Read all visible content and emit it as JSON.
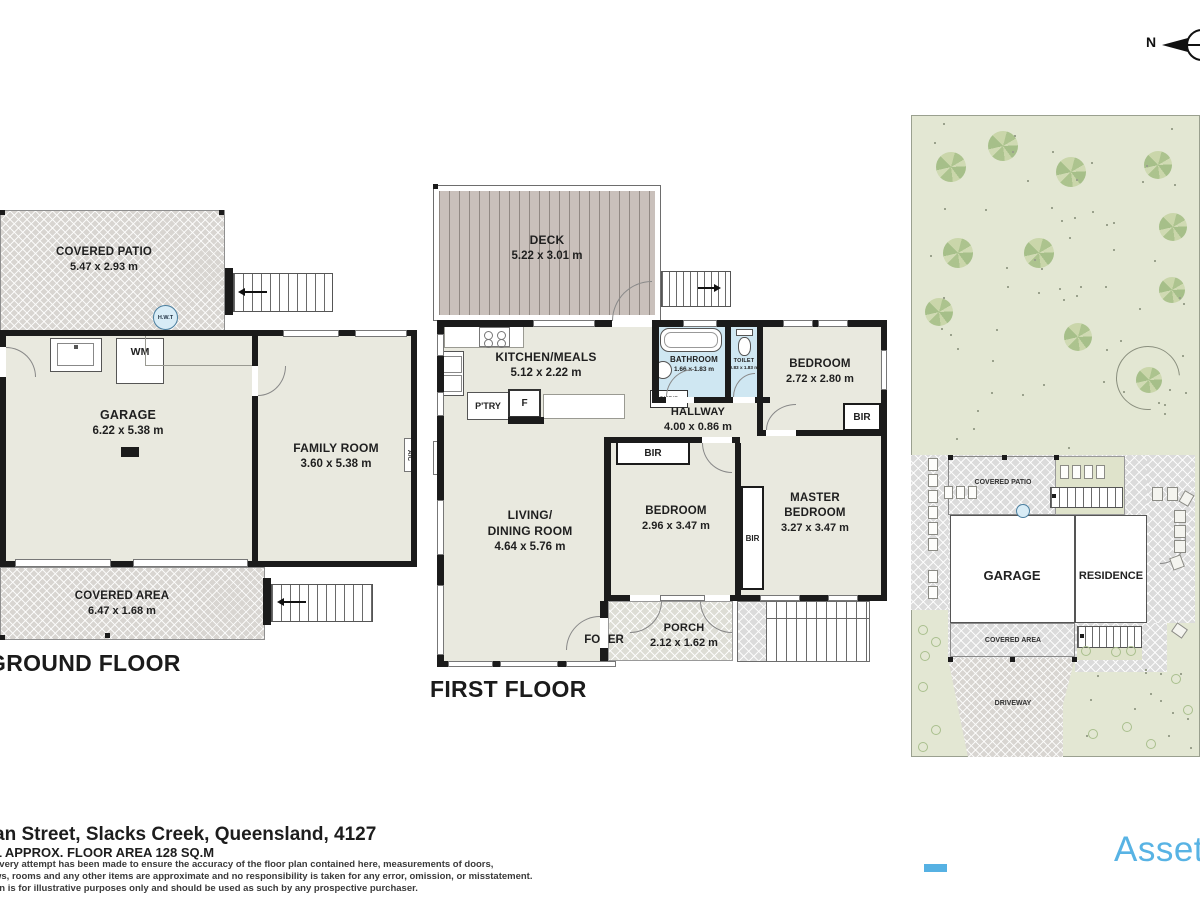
{
  "compass": {
    "n": "N"
  },
  "ground_floor": {
    "title": "GROUND FLOOR",
    "covered_patio": {
      "name": "COVERED PATIO",
      "dims": "5.47 x 2.93 m"
    },
    "hwt_label": "H.W.T",
    "garage": {
      "name": "GARAGE",
      "dims": "6.22 x 5.38 m"
    },
    "family_room": {
      "name": "FAMILY ROOM",
      "dims": "3.60 x 5.38 m"
    },
    "covered_area": {
      "name": "COVERED AREA",
      "dims": "6.47 x 1.68 m"
    },
    "wm_label": "WM",
    "ac_label": "A/C"
  },
  "first_floor": {
    "title": "FIRST FLOOR",
    "deck": {
      "name": "DECK",
      "dims": "5.22 x 3.01 m"
    },
    "kitchen_meals": {
      "name": "KITCHEN/MEALS",
      "dims": "5.12 x 2.22 m"
    },
    "pantry_label": "P'TRY",
    "fridge_label": "F",
    "bathroom": {
      "name": "BATHROOM",
      "dims": "1.66 x 1.83 m"
    },
    "toilet": {
      "name": "TOILET",
      "dims": "0.83 x 1.83 m"
    },
    "cupboard_label": "CUP'D",
    "bedroom_top": {
      "name": "BEDROOM",
      "dims": "2.72 x 2.80 m"
    },
    "hallway": {
      "name": "HALLWAY",
      "dims": "4.00 x 0.86 m"
    },
    "living_dining": {
      "line1": "LIVING/",
      "line2": "DINING ROOM",
      "dims": "4.64 x 5.76 m"
    },
    "bedroom_mid": {
      "name": "BEDROOM",
      "dims": "2.96 x 3.47 m"
    },
    "master_bedroom": {
      "line1": "MASTER",
      "line2": "BEDROOM",
      "dims": "3.27 x 3.47 m"
    },
    "bir_label": "BIR",
    "foyer_label": "FOYER",
    "porch": {
      "name": "PORCH",
      "dims": "2.12 x 1.62 m"
    },
    "ac_label": "A/C"
  },
  "site_plan": {
    "covered_patio_label": "COVERED PATIO",
    "garage_label": "GARAGE",
    "residence_label": "RESIDENCE",
    "covered_area_label": "COVERED AREA",
    "driveway_label": "DRIVEWAY"
  },
  "footer": {
    "address": "an Street, Slacks Creek, Queensland, 4127",
    "floor_area": "L APPROX. FLOOR AREA 128 SQ.M",
    "disclaimer_line1": "every attempt has been made to ensure the accuracy of the floor plan contained here, measurements of doors,",
    "disclaimer_line2": "ws, rooms and any other items are approximate and no responsibility is taken for any error, omission, or misstatement.",
    "disclaimer_line3": "an is for illustrative purposes only and should be used as such by any prospective purchaser."
  },
  "brand": {
    "name": "Asset",
    "accent_color": "#56b1e3"
  },
  "colors": {
    "wall": "#1b1b1b",
    "floor": "#e9e9df",
    "wet_area": "#cfe7f2",
    "paving": "#dbdbdb",
    "grass": "#e3e7d3",
    "deck": "#c9c0bb"
  }
}
